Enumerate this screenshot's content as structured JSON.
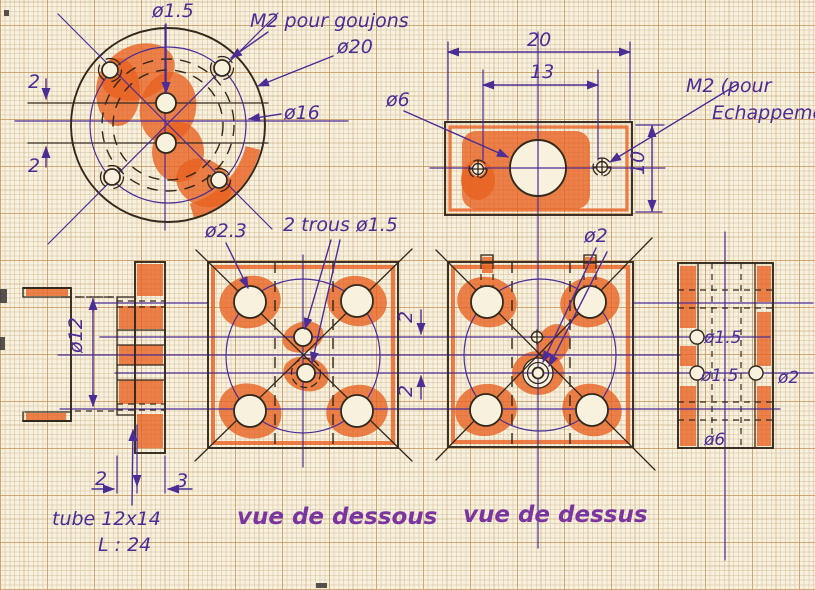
{
  "flange_front": {
    "hole_label": "ø1.5",
    "stud_note": "M2 pour goujons",
    "outer_dia": "ø20",
    "bolt_circle": "ø16",
    "offset_top": "2",
    "offset_bottom": "2"
  },
  "exhaust_plate": {
    "width": "20",
    "hole_spacing": "13",
    "height": "10",
    "bore": "ø6",
    "tap_note_1": "M2 (pour",
    "tap_note_2": "Echappement"
  },
  "side_view": {
    "bore": "ø12",
    "boss_thickness": "2",
    "disc_thickness": "3",
    "tube_note": "tube 12x14",
    "length_note": "L : 24"
  },
  "bottom_view": {
    "caption": "vue de dessous",
    "corner_hole": "ø2.3",
    "center_holes": "2 trous ø1.5",
    "offset_upper": "2",
    "offset_lower": "2"
  },
  "top_view": {
    "caption": "vue de dessus",
    "center_hole": "ø2"
  },
  "section_view": {
    "hole_top": "ø1.5",
    "hole_mid": "ø1.5",
    "side_hole": "ø2",
    "bore": "ø6"
  },
  "colors": {
    "paper": "#f7f1de",
    "grid_fine": "#e3d3b4",
    "grid_bold": "#cf9c66",
    "ink_outline": "#33281c",
    "ink_dimension": "#4b2d96",
    "highlighter": "#e8601f",
    "caption": "#7a35a0"
  }
}
